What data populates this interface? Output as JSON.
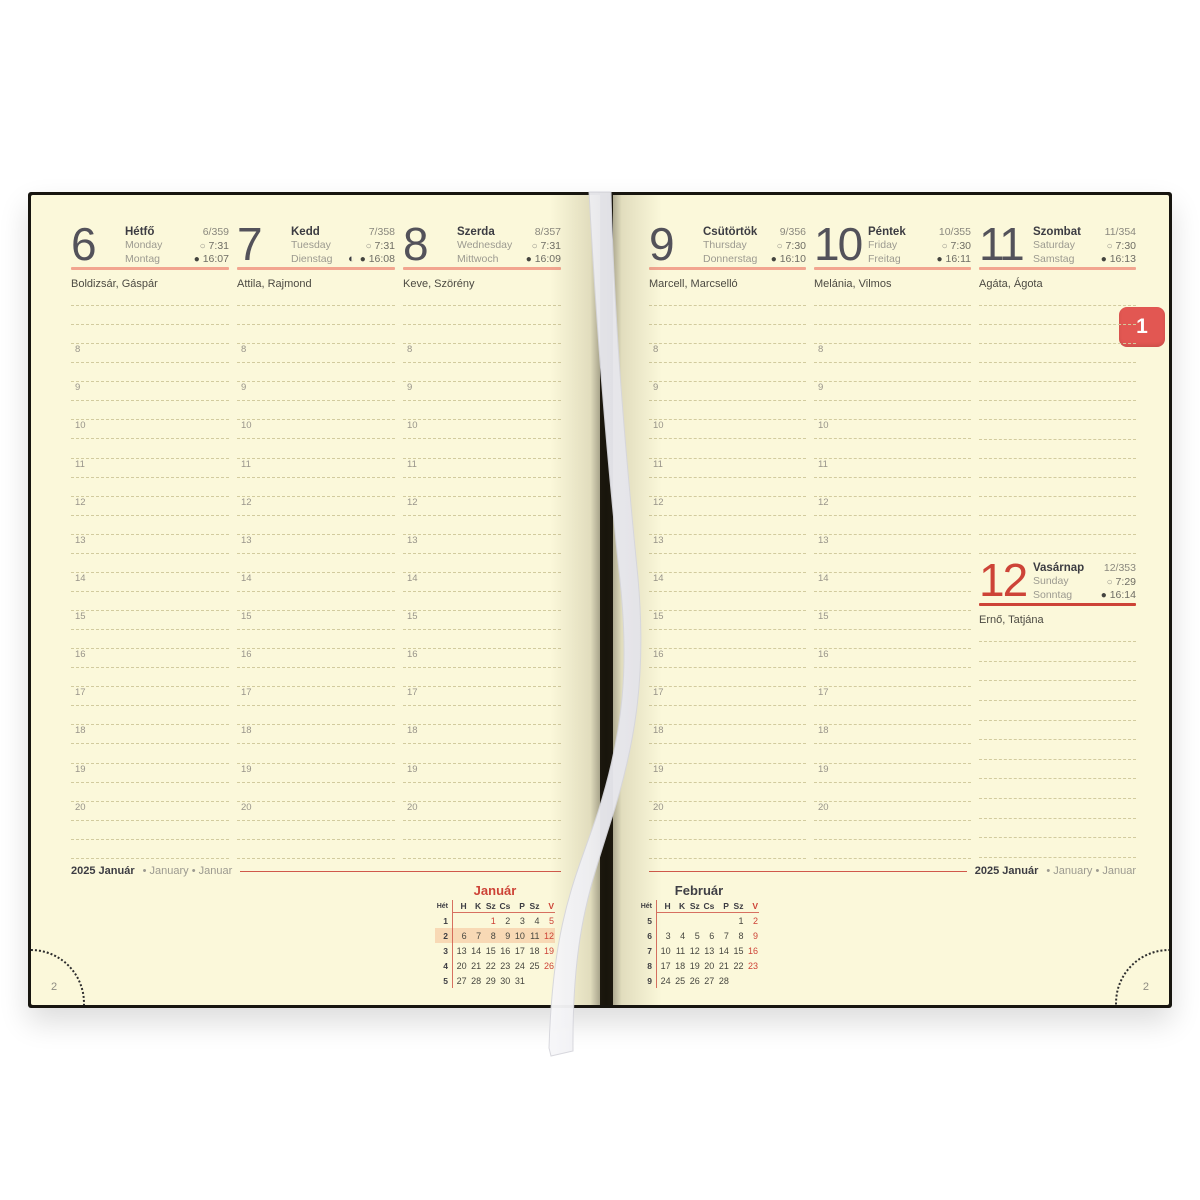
{
  "colors": {
    "page": "#fbf8da",
    "red_accent": "#cd4337",
    "salmon_rule": "#f2a58f",
    "tab_red": "#e25752",
    "highlight_week": "#f8d9b5",
    "line": "#d2cb9e"
  },
  "icons": {
    "sunrise": "○",
    "sunset": "●",
    "moon_first_quarter": "◐"
  },
  "tab": {
    "label": "1"
  },
  "corner": {
    "left_number": "2",
    "right_number": "2"
  },
  "footer": {
    "left": {
      "year_month": "2025 Január",
      "alt": "• January • Januar"
    },
    "right": {
      "year_month": "2025 Január",
      "alt": "• January • Januar"
    }
  },
  "hour_labels": [
    "8",
    "9",
    "10",
    "11",
    "12",
    "13",
    "14",
    "15",
    "16",
    "17",
    "18",
    "19",
    "20"
  ],
  "days": [
    {
      "num": "6",
      "hu": "Hétfő",
      "en": "Monday",
      "de": "Montag",
      "day_of_year": "6/359",
      "sunrise": "7:31",
      "sunset": "16:07",
      "name_day": "Boldizsár, Gáspár",
      "variant": "weekday",
      "moon": false
    },
    {
      "num": "7",
      "hu": "Kedd",
      "en": "Tuesday",
      "de": "Dienstag",
      "day_of_year": "7/358",
      "sunrise": "7:31",
      "sunset": "16:08",
      "name_day": "Attila, Rajmond",
      "variant": "weekday",
      "moon": true
    },
    {
      "num": "8",
      "hu": "Szerda",
      "en": "Wednesday",
      "de": "Mittwoch",
      "day_of_year": "8/357",
      "sunrise": "7:31",
      "sunset": "16:09",
      "name_day": "Keve, Szörény",
      "variant": "weekday",
      "moon": false
    },
    {
      "num": "9",
      "hu": "Csütörtök",
      "en": "Thursday",
      "de": "Donnerstag",
      "day_of_year": "9/356",
      "sunrise": "7:30",
      "sunset": "16:10",
      "name_day": "Marcell, Marcselló",
      "variant": "weekday",
      "moon": false
    },
    {
      "num": "10",
      "hu": "Péntek",
      "en": "Friday",
      "de": "Freitag",
      "day_of_year": "10/355",
      "sunrise": "7:30",
      "sunset": "16:11",
      "name_day": "Melánia, Vilmos",
      "variant": "weekday",
      "moon": false
    },
    {
      "num": "11",
      "hu": "Szombat",
      "en": "Saturday",
      "de": "Samstag",
      "day_of_year": "11/354",
      "sunrise": "7:30",
      "sunset": "16:13",
      "name_day": "Agáta, Ágota",
      "variant": "saturday",
      "moon": false
    },
    {
      "num": "12",
      "hu": "Vasárnap",
      "en": "Sunday",
      "de": "Sonntag",
      "day_of_year": "12/353",
      "sunrise": "7:29",
      "sunset": "16:14",
      "name_day": "Ernő, Tatjána",
      "variant": "sunday",
      "moon": false
    }
  ],
  "mini_calendars": [
    {
      "title": "Január",
      "title_red": true,
      "week_header": "Hét",
      "day_headers": [
        "H",
        "K",
        "Sz",
        "Cs",
        "P",
        "Sz",
        "V"
      ],
      "weeks": [
        {
          "w": "1",
          "days": [
            "",
            "",
            "1",
            "2",
            "3",
            "4",
            "5"
          ],
          "red": [
            2,
            6
          ],
          "highlight": false
        },
        {
          "w": "2",
          "days": [
            "6",
            "7",
            "8",
            "9",
            "10",
            "11",
            "12"
          ],
          "red": [
            6
          ],
          "highlight": true
        },
        {
          "w": "3",
          "days": [
            "13",
            "14",
            "15",
            "16",
            "17",
            "18",
            "19"
          ],
          "red": [
            6
          ],
          "highlight": false
        },
        {
          "w": "4",
          "days": [
            "20",
            "21",
            "22",
            "23",
            "24",
            "25",
            "26"
          ],
          "red": [
            6
          ],
          "highlight": false
        },
        {
          "w": "5",
          "days": [
            "27",
            "28",
            "29",
            "30",
            "31",
            "",
            ""
          ],
          "red": [],
          "highlight": false
        }
      ]
    },
    {
      "title": "Február",
      "title_red": false,
      "week_header": "Hét",
      "day_headers": [
        "H",
        "K",
        "Sz",
        "Cs",
        "P",
        "Sz",
        "V"
      ],
      "weeks": [
        {
          "w": "5",
          "days": [
            "",
            "",
            "",
            "",
            "",
            "1",
            "2"
          ],
          "red": [
            6
          ],
          "highlight": false
        },
        {
          "w": "6",
          "days": [
            "3",
            "4",
            "5",
            "6",
            "7",
            "8",
            "9"
          ],
          "red": [
            6
          ],
          "highlight": false
        },
        {
          "w": "7",
          "days": [
            "10",
            "11",
            "12",
            "13",
            "14",
            "15",
            "16"
          ],
          "red": [
            6
          ],
          "highlight": false
        },
        {
          "w": "8",
          "days": [
            "17",
            "18",
            "19",
            "20",
            "21",
            "22",
            "23"
          ],
          "red": [
            6
          ],
          "highlight": false
        },
        {
          "w": "9",
          "days": [
            "24",
            "25",
            "26",
            "27",
            "28",
            "",
            ""
          ],
          "red": [],
          "highlight": false
        }
      ]
    }
  ]
}
